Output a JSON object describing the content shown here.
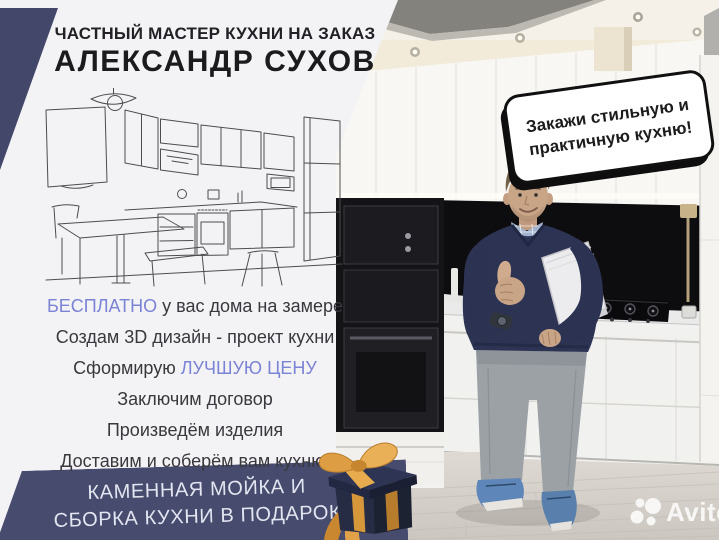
{
  "header": {
    "tagline": "ЧАСТНЫЙ МАСТЕР КУХНИ НА ЗАКАЗ",
    "name": "АЛЕКСАНДР СУХОВ"
  },
  "services": {
    "free_accent": "БЕСПЛАТНО",
    "free_rest": " у вас дома на замере",
    "design": "Создам 3D дизайн - проект кухни",
    "price_prefix": "Сформирую ",
    "price_accent": "ЛУЧШУЮ ЦЕНУ",
    "contract": "Заключим договор",
    "produce": "Произведём изделия",
    "deliver": "Доставим и соберём вам кухню!"
  },
  "banner": {
    "line1": "КАМЕННАЯ МОЙКА И",
    "line2": "СБОРКА КУХНИ В ПОДАРОК"
  },
  "bubble": {
    "line1": "Закажи стильную и",
    "line2": "практичную кухню!"
  },
  "watermark": {
    "brand": "Avito"
  },
  "colors": {
    "navy": "#474b6e",
    "accent_blue": "#7b83d6",
    "ribbon_gold": "#d89c43",
    "backsplash_black": "#0d0d0f",
    "bubble_outline": "#101010"
  },
  "icons": {
    "gift": "gift-box-icon",
    "avito": "avito-logo-icon",
    "speech": "speech-bubble"
  }
}
